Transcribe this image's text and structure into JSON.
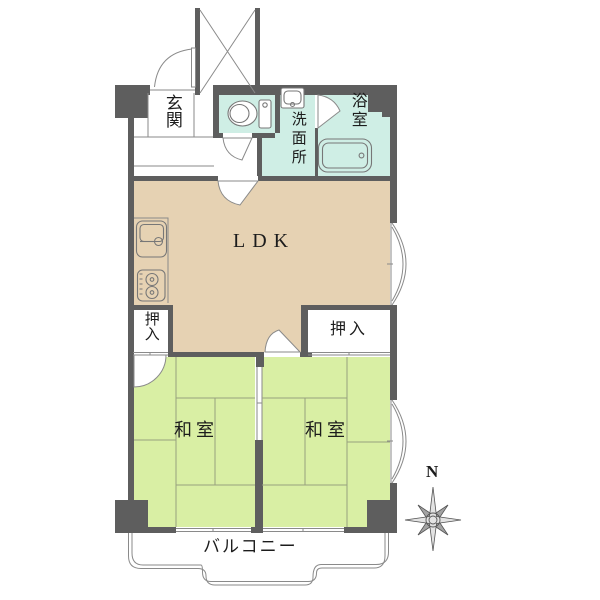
{
  "labels": {
    "genkan": "玄関",
    "washroom": "洗面所",
    "bathroom": "浴室",
    "ldk": "LDK",
    "closet_left": "押入",
    "closet_right": "押入",
    "washitsu_left": "和室",
    "washitsu_right": "和室",
    "balcony": "バルコニー",
    "compass_north": "N"
  },
  "colors": {
    "wall": "#5e5e5e",
    "ldk": "#e6d2b3",
    "tatami": "#d9efa4",
    "wet": "#cfeee5",
    "line": "#8a8a8a",
    "tatami_line": "#98a07e",
    "text": "#1c1c1c"
  }
}
